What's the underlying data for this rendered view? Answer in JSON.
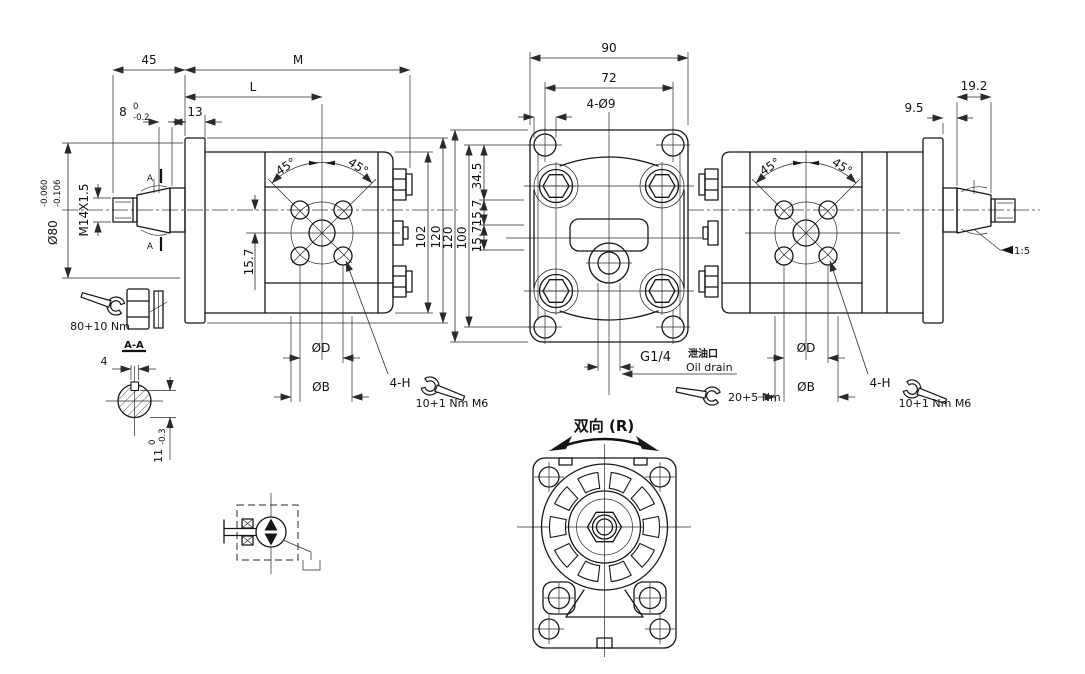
{
  "drawing_title": "Bidirectional gear pump / motor engineering drawing",
  "shared": {
    "angle_45": "45°",
    "dia_d": "ØD",
    "dia_b": "ØB",
    "four_h": "4-H",
    "torque_m6": "10+1 Nm M6",
    "dim_15_7": "15.7",
    "dim_120": "120",
    "section_a": "A"
  },
  "left_view": {
    "dim_45": "45",
    "dim_m": "M",
    "dim_l": "L",
    "dim_13": "13",
    "dim_8": "8",
    "tol_8_hi": "0",
    "tol_8_lo": "-0.2",
    "dia_80": "Ø80",
    "tol_80_hi": "-0.060",
    "tol_80_lo": "-0.106",
    "thread": "M14X1.5",
    "dim_102": "102",
    "torque_nut": "80+10 Nm"
  },
  "section_aa": {
    "title": "A-A",
    "key_width": "4",
    "key_depth": "11",
    "tol_hi": "0",
    "tol_lo": "-0.3"
  },
  "front_view": {
    "dim_90": "90",
    "dim_72": "72",
    "mount_holes": "4-Ø9",
    "dim_34_5": "34.5",
    "dim_100": "100",
    "drain_port": "G1/4",
    "drain_label_cn": "泄油口",
    "drain_label_en": "Oil drain",
    "torque_port": "20+5 Nm",
    "direction_label": "双向 (R)"
  },
  "right_view": {
    "dim_19_2": "19.2",
    "dim_9_5": "9.5",
    "taper": "1:5"
  }
}
